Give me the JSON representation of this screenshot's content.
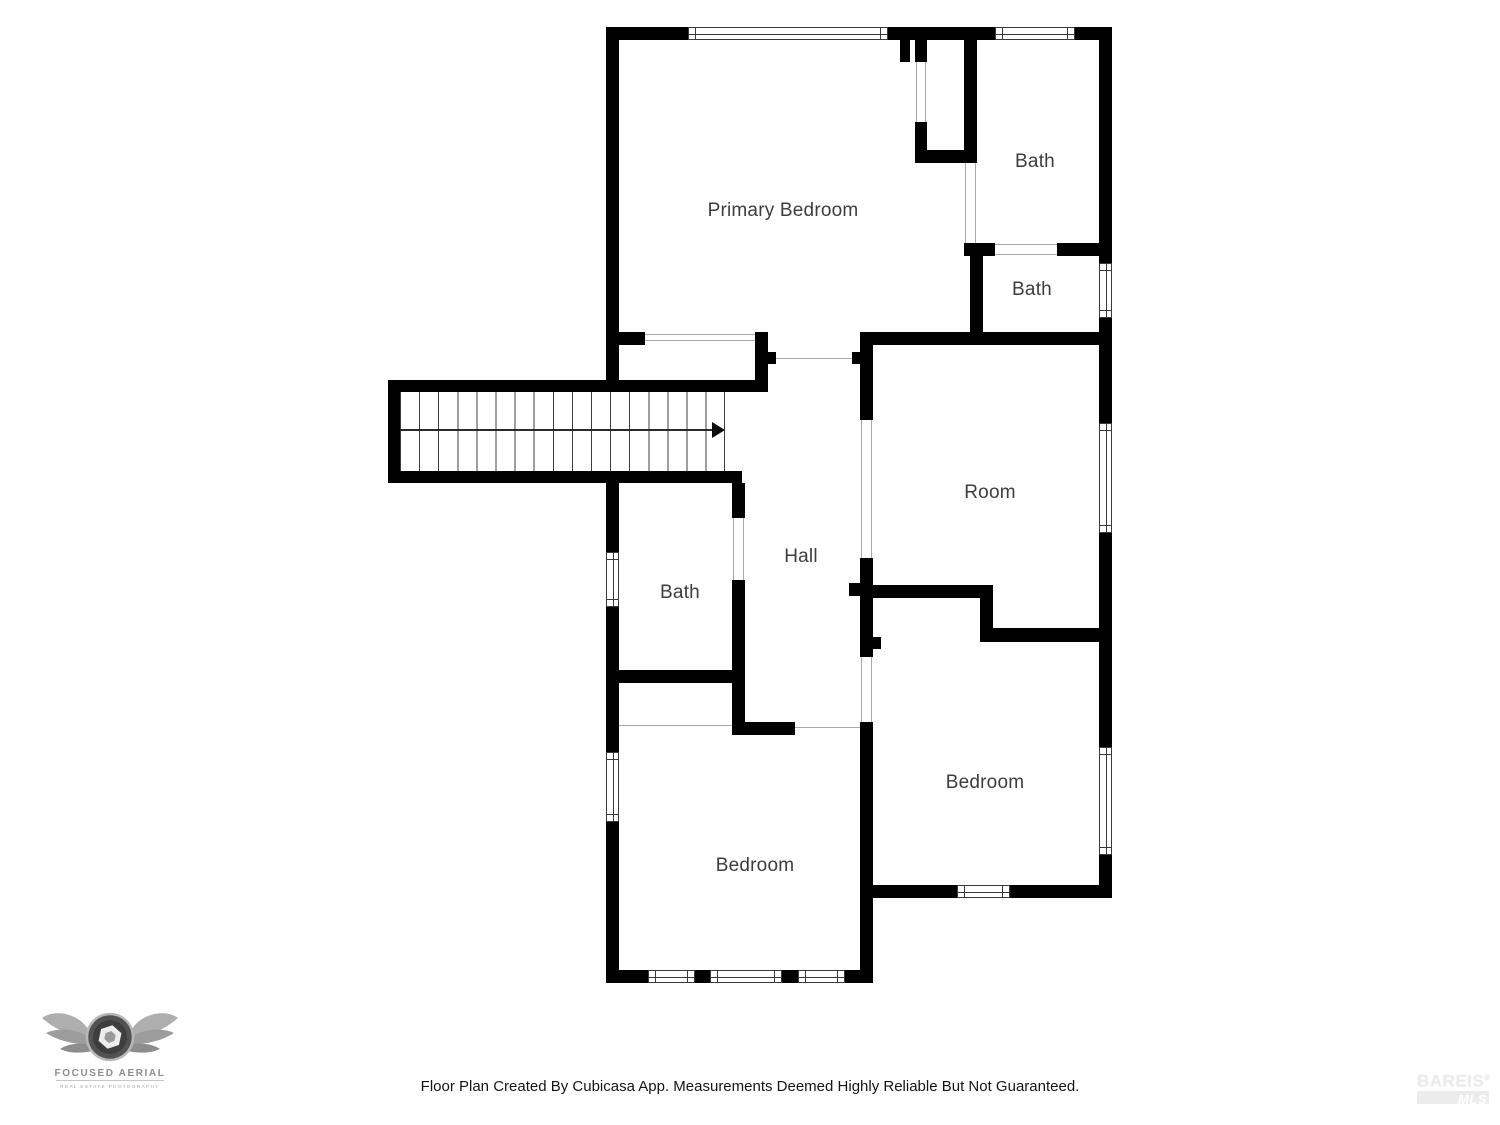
{
  "rooms": {
    "primary_bedroom": "Primary Bedroom",
    "bath_ensuite": "Bath",
    "bath_small": "Bath",
    "room": "Room",
    "hall": "Hall",
    "bath_hall": "Bath",
    "bedroom_right": "Bedroom",
    "bedroom_left": "Bedroom"
  },
  "footer": {
    "disclaimer": "Floor Plan Created By Cubicasa App. Measurements Deemed Highly Reliable But Not Guaranteed."
  },
  "logo": {
    "name": "FOCUSED AERIAL",
    "tagline": "REAL ESTATE PHOTOGRAPHY"
  },
  "watermark": {
    "brand": "BAREIS",
    "registered": "®",
    "mls": "MLS"
  },
  "colors": {
    "wall": "#000000",
    "label_text": "#3d3d3d",
    "opening_line": "#a8a8a8"
  }
}
